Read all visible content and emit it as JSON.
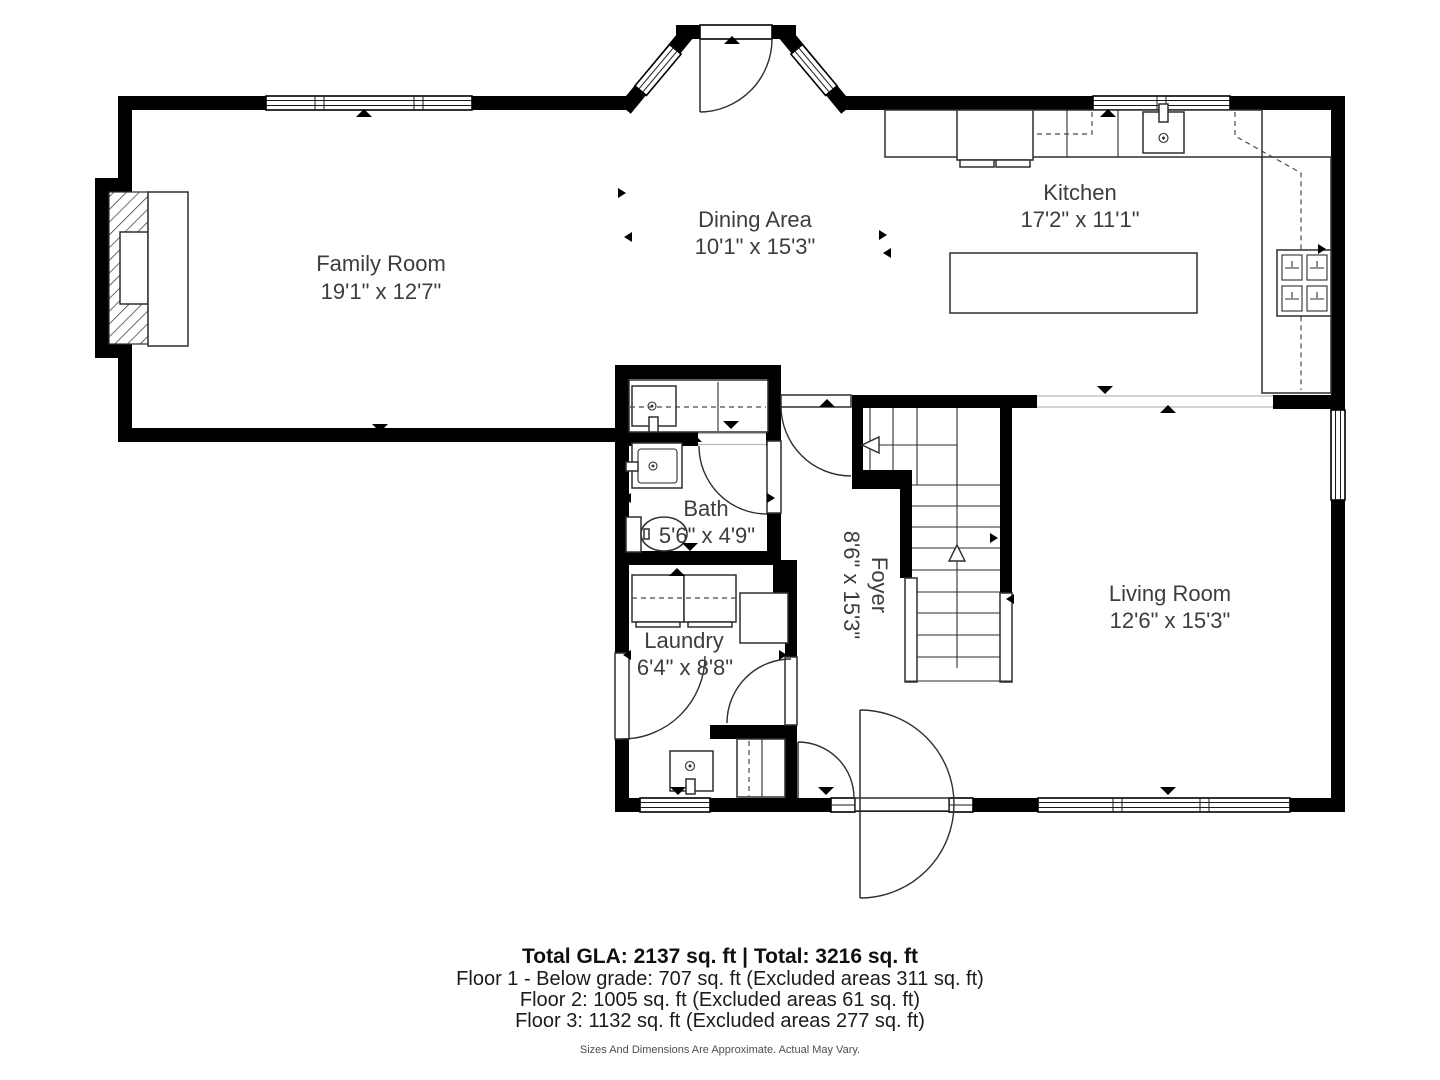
{
  "plan": {
    "title": "First floor plan",
    "rooms": {
      "family": {
        "name": "Family Room",
        "dims": "19'1\" x 12'7\""
      },
      "dining": {
        "name": "Dining Area",
        "dims": "10'1\" x 15'3\""
      },
      "kitchen": {
        "name": "Kitchen",
        "dims": "17'2\" x 11'1\""
      },
      "bath": {
        "name": "Bath",
        "dims": "5'6\" x 4'9\""
      },
      "foyer": {
        "name": "Foyer",
        "dims": "8'6\" x 15'3\""
      },
      "laundry": {
        "name": "Laundry",
        "dims": "6'4\" x 8'8\""
      },
      "living": {
        "name": "Living Room",
        "dims": "12'6\" x 15'3\""
      }
    }
  },
  "footer": {
    "totals": "Total GLA: 2137 sq. ft | Total: 3216 sq. ft",
    "floor1": "Floor 1 - Below grade: 707 sq. ft (Excluded areas 311 sq. ft)",
    "floor2": "Floor 2: 1005 sq. ft (Excluded areas 61 sq. ft)",
    "floor3": "Floor 3: 1132 sq. ft (Excluded areas 277 sq. ft)",
    "disclaimer": "Sizes And Dimensions Are Approximate. Actual May Vary."
  },
  "colors": {
    "wall": "#000000",
    "line": "#2e2e2e",
    "label": "#3d3d3d",
    "background": "#ffffff"
  }
}
